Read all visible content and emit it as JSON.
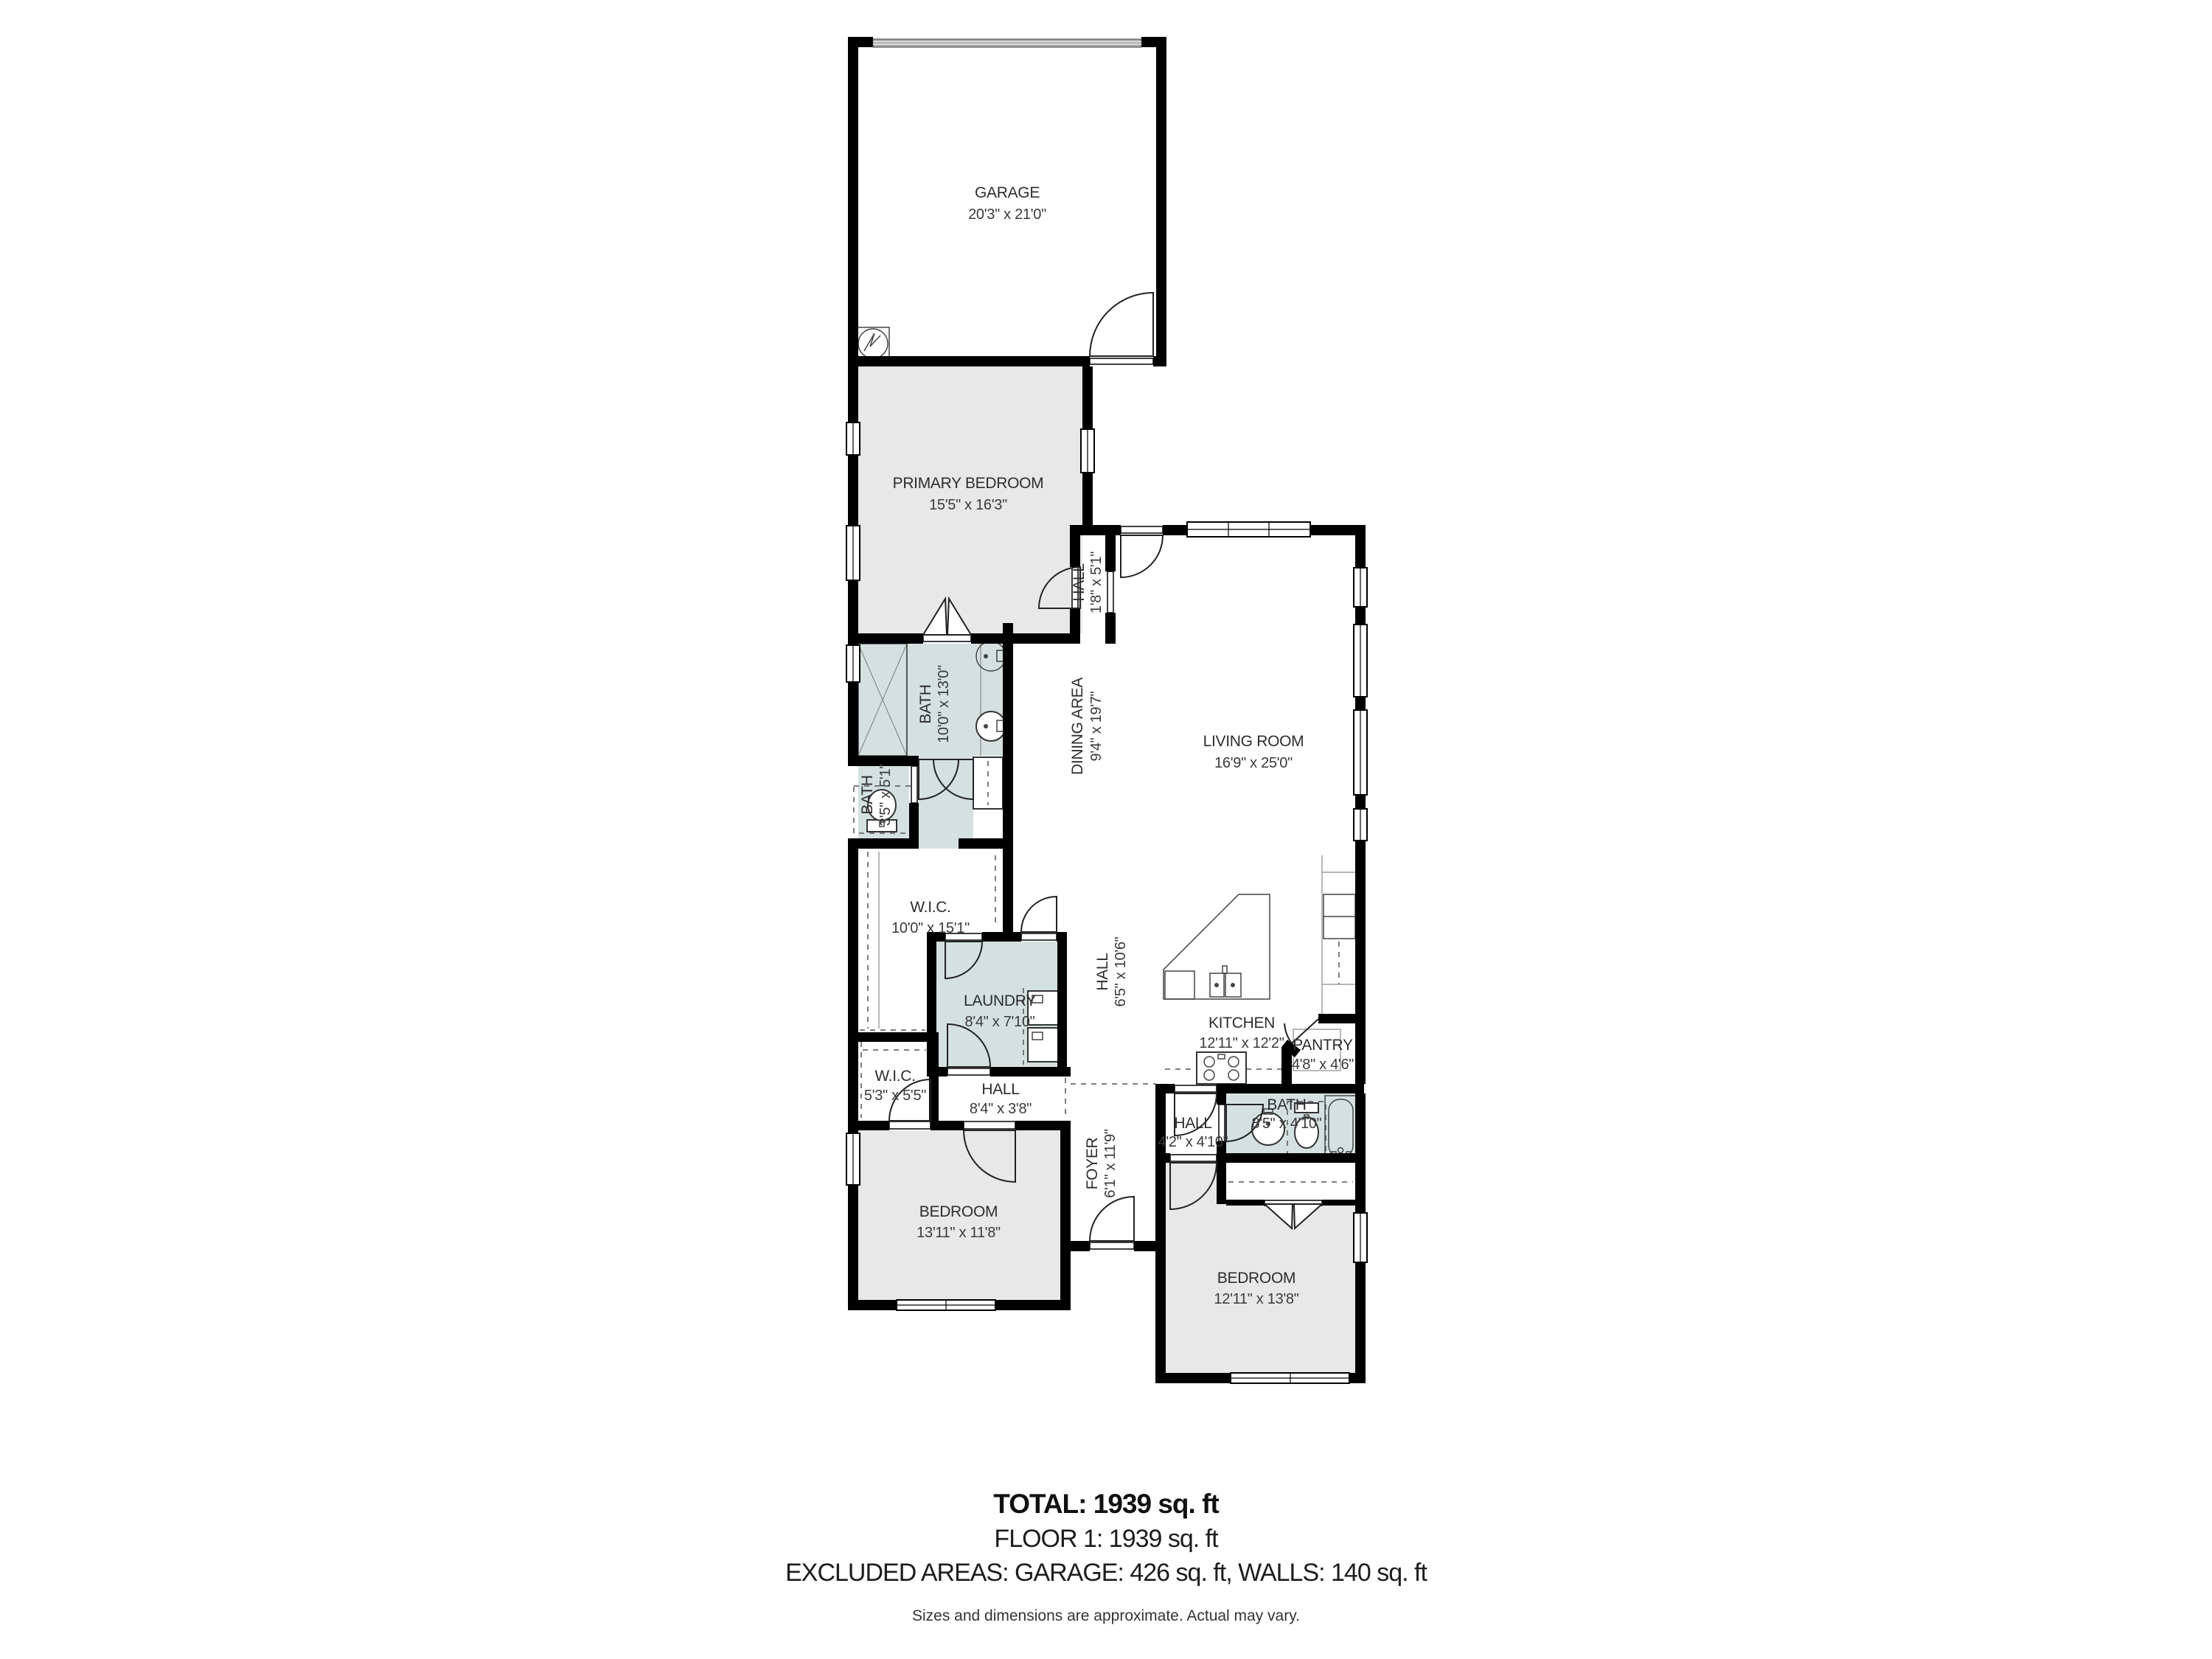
{
  "plan": {
    "colors": {
      "wall": "#000000",
      "dry_room_fill": "#e8e8e8",
      "wet_room_fill": "#d5e1e1",
      "background": "#ffffff",
      "label_text": "#2d2d2d"
    },
    "rooms": {
      "garage": {
        "name": "GARAGE",
        "dims": "20'3\" x 21'0\""
      },
      "primary_bedroom": {
        "name": "PRIMARY BEDROOM",
        "dims": "15'5\" x 16'3\""
      },
      "hall_primary": {
        "name": "HALL",
        "dims": "1'8\" x 5'1\""
      },
      "living_room": {
        "name": "LIVING ROOM",
        "dims": "16'9\" x 25'0\""
      },
      "dining_area": {
        "name": "DINING AREA",
        "dims": "9'4\" x 19'7\""
      },
      "bath_primary": {
        "name": "BATH",
        "dims": "10'0\" x 13'0\""
      },
      "bath_small": {
        "name": "BATH",
        "dims": "3'5\" x 5'1\""
      },
      "wic_large": {
        "name": "W.I.C.",
        "dims": "10'0\" x 15'1\""
      },
      "laundry": {
        "name": "LAUNDRY",
        "dims": "8'4\" x 7'10\""
      },
      "hall_center": {
        "name": "HALL",
        "dims": "6'5\" x 10'6\""
      },
      "kitchen": {
        "name": "KITCHEN",
        "dims": "12'11\" x 12'2\""
      },
      "pantry": {
        "name": "PANTRY",
        "dims": "4'8\" x 4'6\""
      },
      "wic_small": {
        "name": "W.I.C.",
        "dims": "5'3\" x 5'5\""
      },
      "hall_lower": {
        "name": "HALL",
        "dims": "8'4\" x 3'8\""
      },
      "foyer": {
        "name": "FOYER",
        "dims": "6'1\" x 11'9\""
      },
      "hall_bath": {
        "name": "HALL",
        "dims": "4'2\" x 4'10\""
      },
      "bath_hall": {
        "name": "BATH",
        "dims": "8'5\" x 4'10\""
      },
      "bedroom_left": {
        "name": "BEDROOM",
        "dims": "13'11\" x 11'8\""
      },
      "bedroom_right": {
        "name": "BEDROOM",
        "dims": "12'11\" x 13'8\""
      }
    },
    "summary": {
      "total": "TOTAL: 1939 sq. ft",
      "floor": "FLOOR 1: 1939 sq. ft",
      "excluded": "EXCLUDED AREAS: GARAGE: 426 sq. ft, WALLS: 140 sq. ft",
      "disclaimer": "Sizes and dimensions are approximate. Actual may vary."
    }
  }
}
